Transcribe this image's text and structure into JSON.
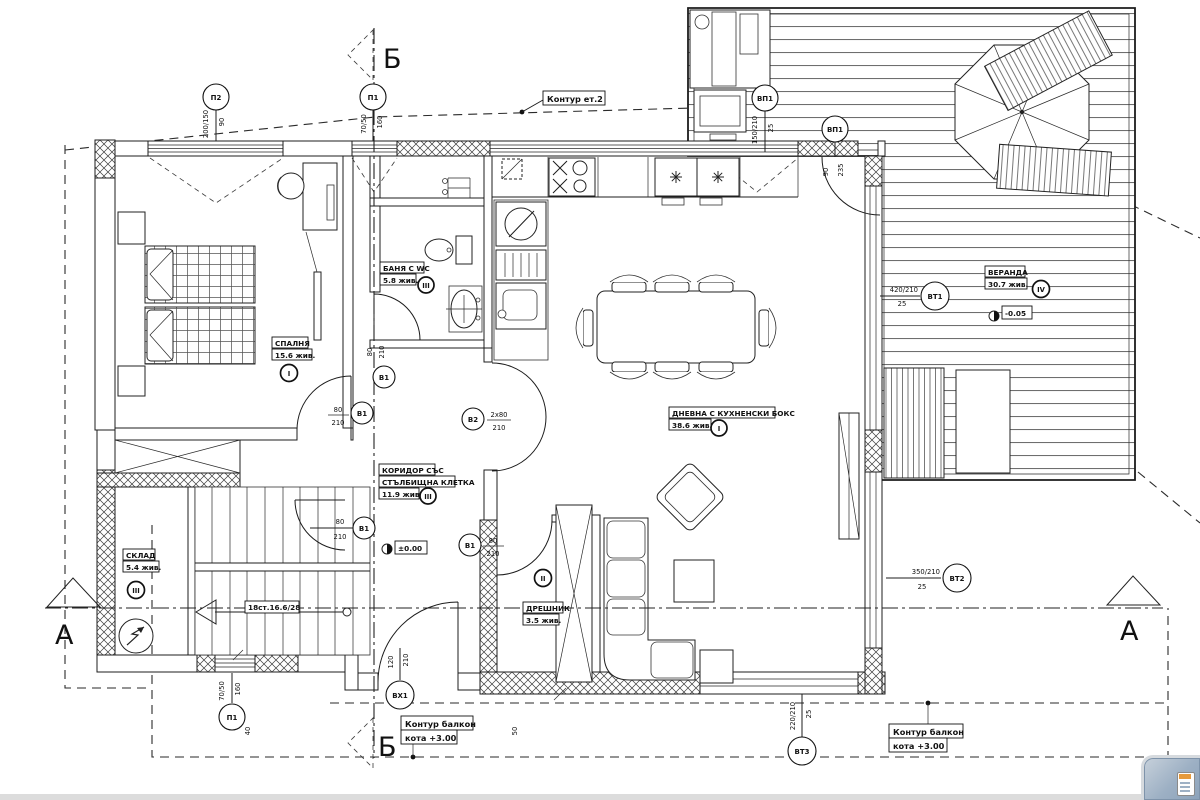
{
  "sections": {
    "a": "А",
    "b": "Б"
  },
  "contours": {
    "floor2": "Контур ет.2",
    "balcony_l1": "Контур балкон",
    "balcony_l2": "кота +3.00"
  },
  "levels": {
    "main": "±0.00",
    "veranda": "-0.05"
  },
  "rooms": {
    "bedroom": {
      "name": "СПАЛНЯ",
      "area": "15.6 жив.",
      "marker": "I"
    },
    "bath": {
      "name": "БАНЯ С WC",
      "area": "5.8 жив.",
      "marker": "III"
    },
    "living": {
      "name": "ДНЕВНА С КУХНЕНСКИ БОКС",
      "area": "38.6 жив.",
      "marker": "I"
    },
    "corridor": {
      "name_l1": "КОРИДОР СЪС",
      "name_l2": "СТЪЛБИЩНА КЛЕТКА",
      "area": "11.9 жив.",
      "marker": "III"
    },
    "storage": {
      "name": "СКЛАД",
      "area": "5.4 жив.",
      "marker": "III"
    },
    "closet": {
      "name": "ДРЕШНИК",
      "area": "3.5 жив.",
      "marker": "II"
    },
    "veranda": {
      "name": "ВЕРАНДА",
      "area": "30.7 жив.",
      "marker": "IV"
    }
  },
  "openings": {
    "p2_top": {
      "id": "П2",
      "dim1": "200/150",
      "dim2": "90"
    },
    "p1_top": {
      "id": "П1",
      "dim1": "70/50",
      "dim2": "160"
    },
    "p1_bottom": {
      "id": "П1",
      "dim1": "70/50",
      "dim2": "160"
    },
    "vp1_a": {
      "id": "ВП1",
      "dim1": "150/210",
      "dim2": "25"
    },
    "vp1_b": {
      "id": "ВП1",
      "dim1": "90",
      "dim2": "235"
    },
    "vt1": {
      "id": "ВТ1",
      "dim1": "420/210",
      "dim2": "25"
    },
    "vt2": {
      "id": "ВТ2",
      "dim1": "350/210",
      "dim2": "25"
    },
    "vt3": {
      "id": "ВТ3",
      "dim1": "220/210",
      "dim2": "25"
    },
    "vh1": {
      "id": "ВХ1",
      "dim1": "120",
      "dim2": "210"
    },
    "v1": {
      "id": "В1",
      "dim1": "80",
      "dim2": "210"
    },
    "v2": {
      "id": "В2",
      "dim1": "2x80",
      "dim2": "210"
    }
  },
  "stairs": {
    "label": "18ст.16.6/28"
  },
  "dims": {
    "d40": "40",
    "d50": "50"
  },
  "misc": {
    "corner_icon": "document-popup-icon"
  }
}
